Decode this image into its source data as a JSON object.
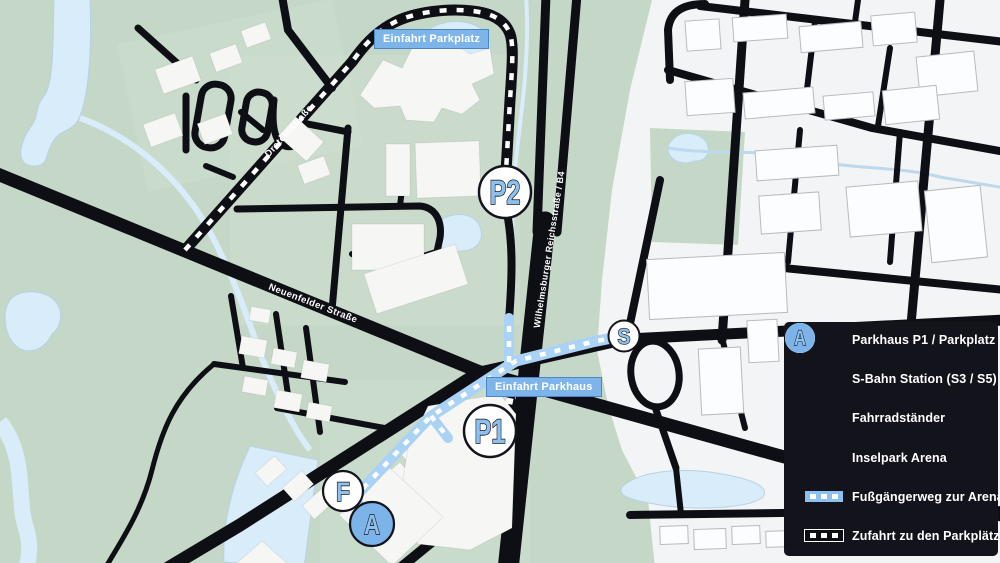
{
  "badges": {
    "parkplatz": "Einfahrt Parkplatz",
    "parkhaus": "Einfahrt Parkhaus"
  },
  "streets": {
    "drateln": "Dratelnstraße",
    "neuenfelder": "Neuenfelder Straße",
    "wilhelmsburger": "Wilhelmsburger Reichsstraße / B4"
  },
  "markers": {
    "p2": "P2",
    "p1": "P1",
    "s": "S",
    "f": "F",
    "a": "A"
  },
  "legend": {
    "items": [
      {
        "icon": "P",
        "style": "circle-white",
        "label": "Parkhaus P1 / Parkplatz P2"
      },
      {
        "icon": "S",
        "style": "circle-white",
        "label": "S-Bahn Station (S3 / S5)"
      },
      {
        "icon": "F",
        "style": "circle-white",
        "label": "Fahrradständer"
      },
      {
        "icon": "A",
        "style": "circle-blue",
        "label": "Inselpark Arena"
      },
      {
        "icon": "path-dashed-blue",
        "style": "line-blue",
        "label": "Fußgängerweg zur Arena"
      },
      {
        "icon": "road-dashed-black",
        "style": "line-black",
        "label": "Zufahrt zu den Parkplätzen"
      }
    ]
  },
  "colors": {
    "map_green": "#c5d7c7",
    "map_green_light": "#cfdfcf",
    "white_district": "#f3f4f5",
    "road_black": "#0e0e15",
    "water_blue": "#d8ecfa",
    "pedestrian_path_blue": "#a9d2f4",
    "marker_letter_blue": "#8cc0ee",
    "arena_marker_blue": "#7cb3e8",
    "badge_blue": "#7db5ea",
    "legend_background": "#13131b"
  }
}
